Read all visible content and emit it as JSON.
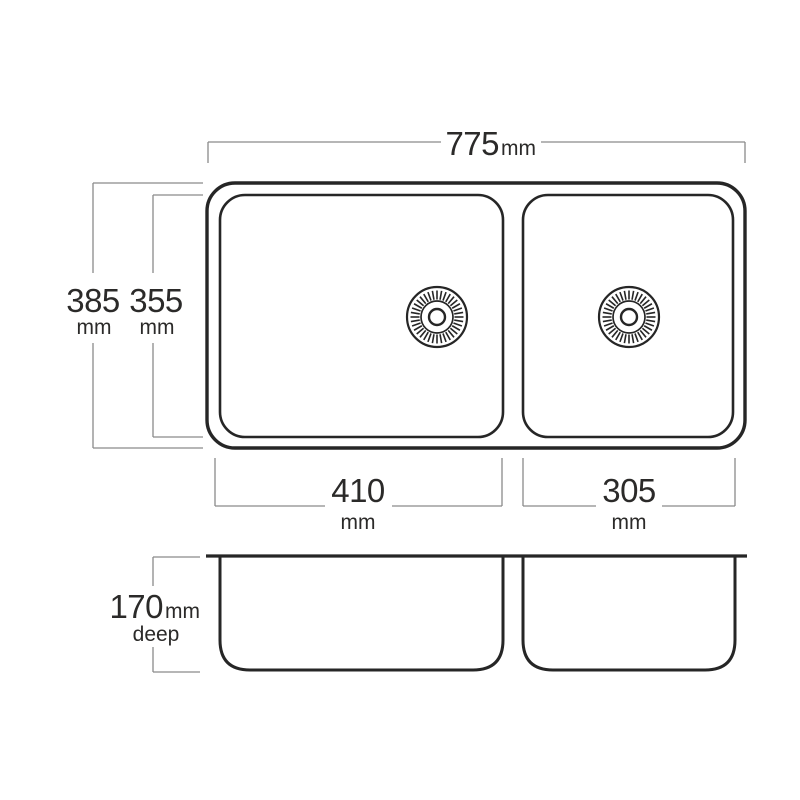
{
  "colors": {
    "background": "#ffffff",
    "outline": "#262626",
    "dimension_line": "#8a8a8a",
    "text": "#2b2a29"
  },
  "dimensions": {
    "overall_width": {
      "value": "775",
      "unit": "mm"
    },
    "overall_front_to_back": {
      "value": "385",
      "unit": "mm"
    },
    "bowl_front_to_back": {
      "value": "355",
      "unit": "mm"
    },
    "left_bowl_width": {
      "value": "410",
      "unit": "mm"
    },
    "right_bowl_width": {
      "value": "305",
      "unit": "mm"
    },
    "bowl_depth": {
      "value": "170",
      "unit": "mm",
      "label": "deep"
    }
  }
}
